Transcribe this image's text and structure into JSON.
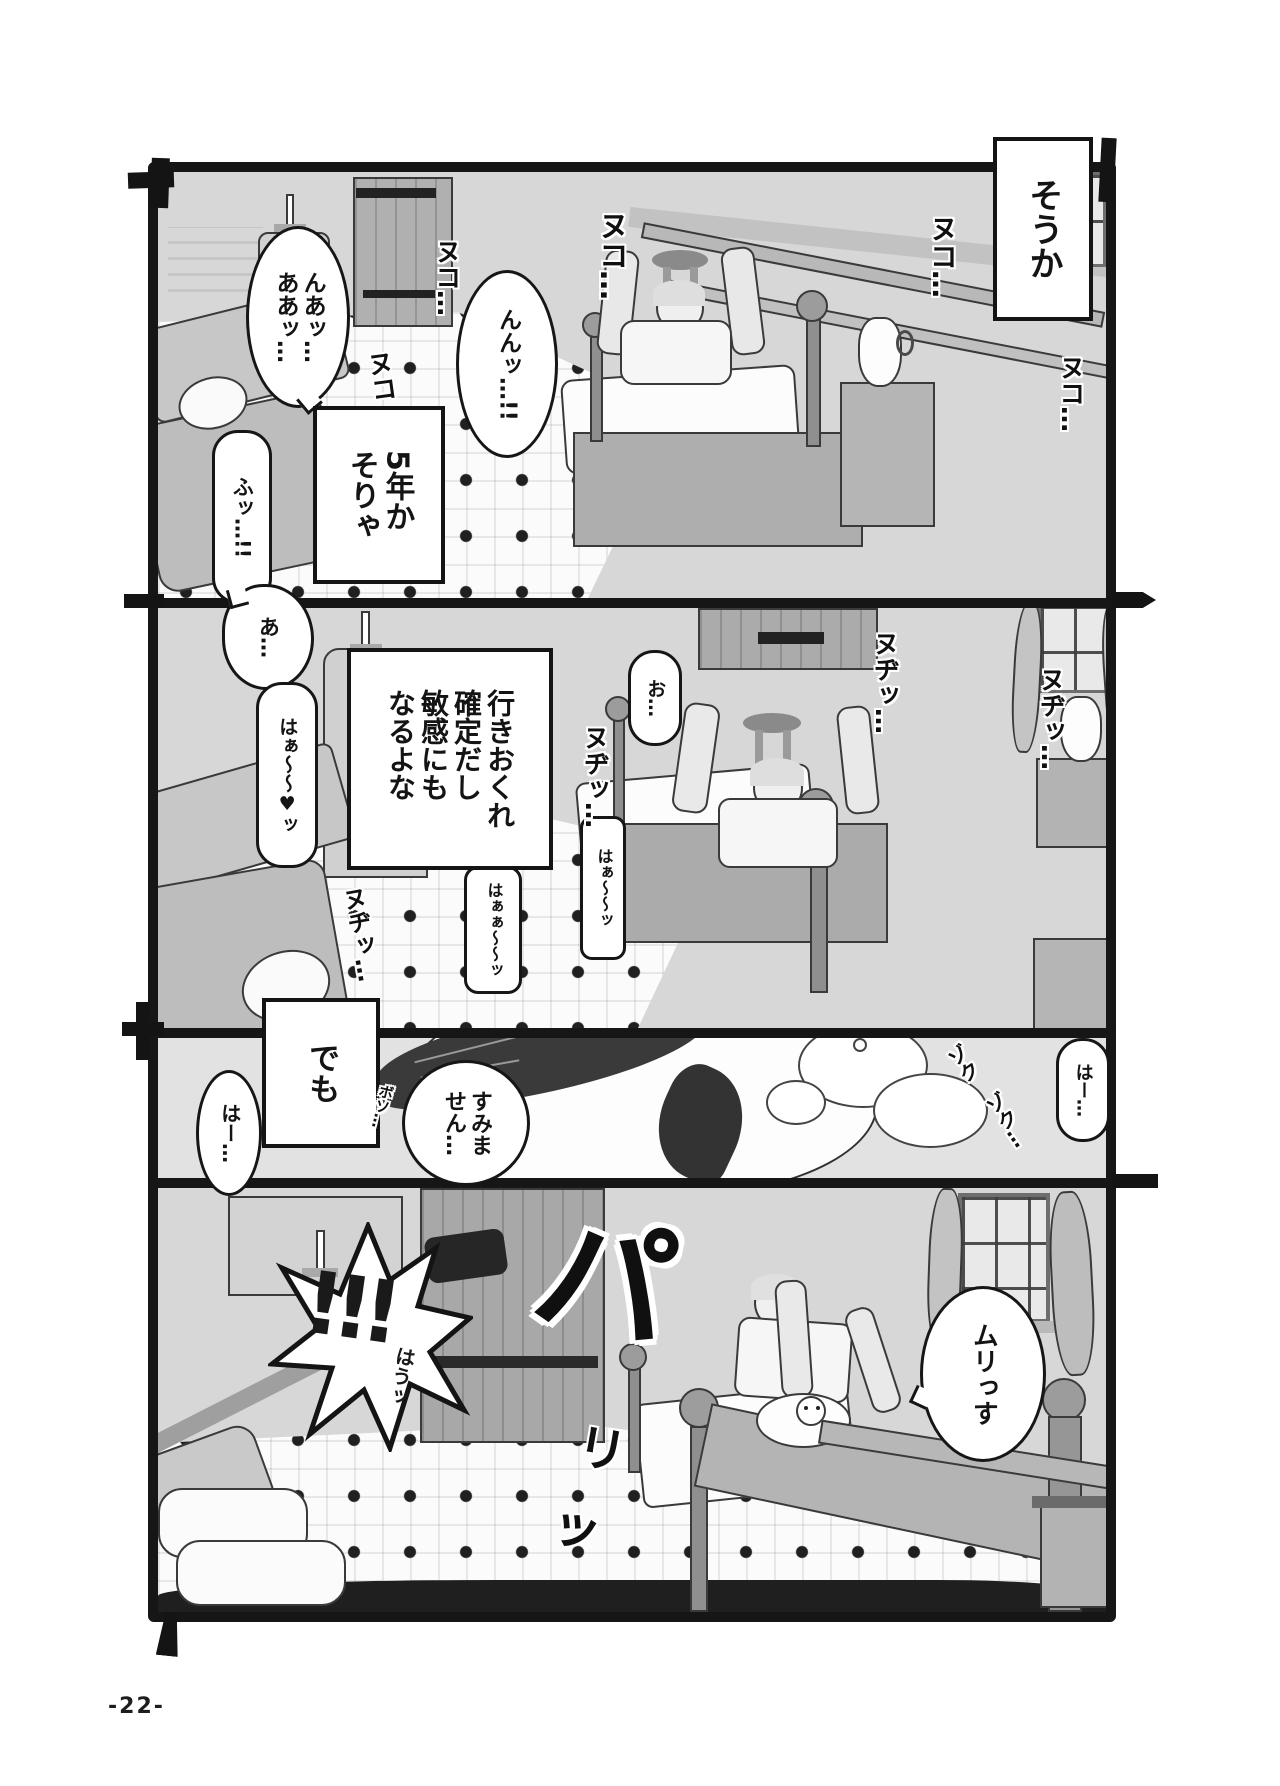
{
  "page": {
    "number_label": "-22-"
  },
  "colors": {
    "ink": "#161616",
    "paper": "#ffffff",
    "wall": "#d7d7d7",
    "accent_dark": "#1f1f1f"
  },
  "panel1": {
    "caption_top_right": "そうか",
    "caption_mid_left": "5年か\nそりゃ",
    "bubble_top_left": "んあッ…\nああッ…",
    "bubble_center": "んんッ…!!",
    "bubble_bottom_left": "ふッ…!!",
    "sfx_nuko_a": "ヌコ…",
    "sfx_nuko_b": "ヌコ…",
    "sfx_nuko_c": "ヌコ",
    "sfx_nuko_d": "ヌコ…",
    "sfx_nuko_e": "ヌコ…"
  },
  "panel2": {
    "caption": "行きおくれ\n確定だし\n敏感にも\nなるよな",
    "bubble_a": "あ…",
    "bubble_haa_heart": "はぁ〜〜♥ッ",
    "bubble_o": "お…",
    "bubble_haa_long": "はぁ〜〜ッ",
    "bubble_haa_double": "はぁぁ〜〜ッ",
    "sfx_nudi_a": "ヌヂッ…",
    "sfx_nudi_b": "ヌヂッ…",
    "sfx_nudi_c": "ヌヂッ…",
    "sfx_nudi_d": "ヌヂッ…"
  },
  "panel3": {
    "caption": "でも",
    "bubble_haa_left": "はー…",
    "bubble_apology": "すみま\nせん…",
    "sfx_boso": "ボソ…",
    "sfx_zoku_a": "ゾク",
    "sfx_zoku_b": "ゾク…",
    "bubble_haa_right": "はー…"
  },
  "panel4": {
    "burst_exclaim": "!!!",
    "burst_hau": "はうッ",
    "sfx_pa": "パ",
    "sfx_ri": "リ",
    "sfx_tsu": "ッ",
    "bubble_refusal": "ムリっす"
  }
}
